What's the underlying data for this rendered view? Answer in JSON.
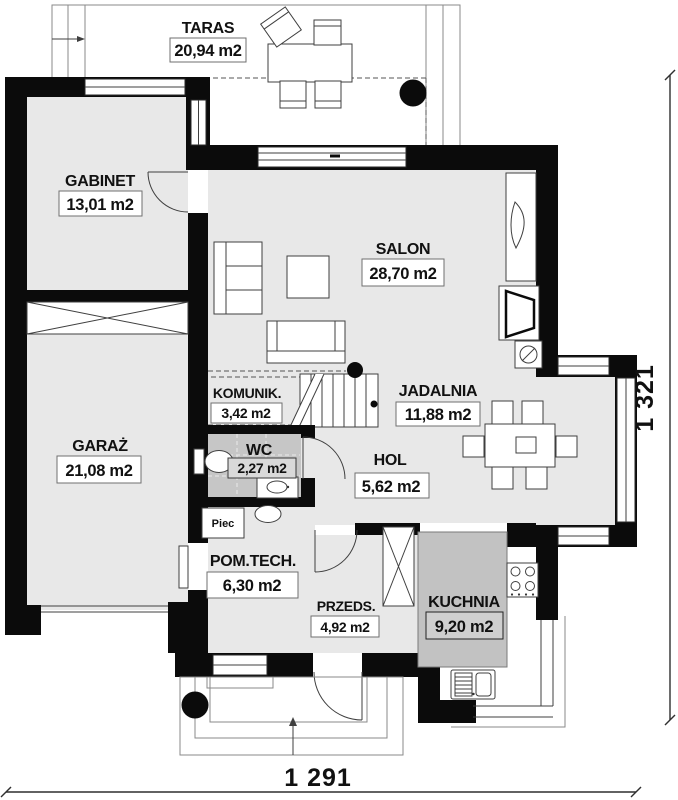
{
  "rooms": [
    {
      "id": "taras",
      "name": "TARAS",
      "area": "20,94 m2"
    },
    {
      "id": "gabinet",
      "name": "GABINET",
      "area": "13,01 m2"
    },
    {
      "id": "salon",
      "name": "SALON",
      "area": "28,70 m2"
    },
    {
      "id": "garaz",
      "name": "GARAŻ",
      "area": "21,08 m2"
    },
    {
      "id": "komunik",
      "name": "KOMUNIK.",
      "area": "3,42 m2"
    },
    {
      "id": "wc",
      "name": "WC",
      "area": "2,27 m2"
    },
    {
      "id": "jadalnia",
      "name": "JADALNIA",
      "area": "11,88 m2"
    },
    {
      "id": "hol",
      "name": "HOL",
      "area": "5,62 m2"
    },
    {
      "id": "pomtech",
      "name": "POM.TECH.",
      "area": "6,30 m2"
    },
    {
      "id": "przeds",
      "name": "PRZEDS.",
      "area": "4,92 m2"
    },
    {
      "id": "kuchnia",
      "name": "KUCHNIA",
      "area": "9,20 m2"
    }
  ],
  "equipment": {
    "furnace_label": "Piec"
  },
  "dimensions": {
    "overall_width": "1 291",
    "overall_height": "1 321"
  },
  "colors": {
    "wall": "#0b0b0b",
    "floor": "#e8e8e8",
    "floor_wc": "#c6c6c6",
    "kitchen_counter": "#c2c2c2",
    "line": "#3f3f3f",
    "background": "#ffffff"
  }
}
